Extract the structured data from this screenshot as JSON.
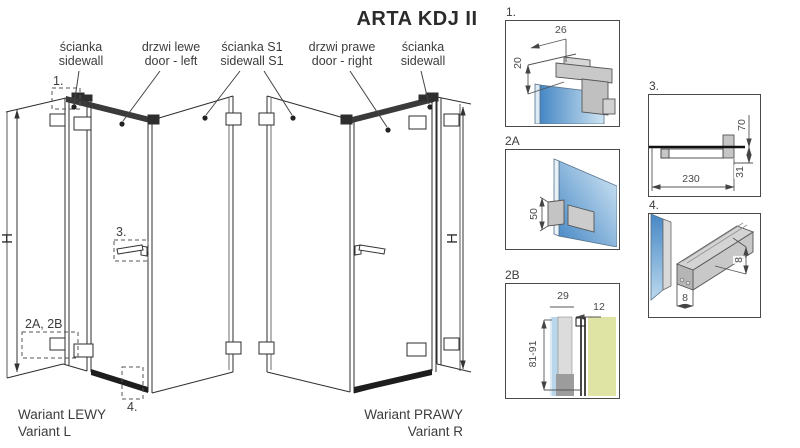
{
  "title": "ARTA KDJ II",
  "labels": {
    "sidewall_l": {
      "line1": "ścianka",
      "line2": "sidewall"
    },
    "door_l": {
      "line1": "drzwi lewe",
      "line2": "door - left"
    },
    "s1": {
      "line1": "ścianka S1",
      "line2": "sidewall S1"
    },
    "door_r": {
      "line1": "drzwi prawe",
      "line2": "door - right"
    },
    "sidewall_r": {
      "line1": "ścianka",
      "line2": "sidewall"
    }
  },
  "variant_left": {
    "line1": "Wariant LEWY",
    "line2": "Variant L"
  },
  "variant_right": {
    "line1": "Wariant PRAWY",
    "line2": "Variant R"
  },
  "height_label": "H",
  "callouts": {
    "c1": "1.",
    "c2": "2A, 2B",
    "c3": "3.",
    "c4": "4."
  },
  "details": {
    "d1": {
      "label": "1.",
      "dim_width": "26",
      "dim_height": "20"
    },
    "d2a": {
      "label": "2A",
      "dim_height": "50"
    },
    "d2b": {
      "label": "2B",
      "dim_w1": "29",
      "dim_w2": "12",
      "dim_range": "81-91"
    },
    "d3": {
      "label": "3.",
      "dim_h": "70",
      "dim_drop": "31",
      "dim_len": "230"
    },
    "d4": {
      "label": "4.",
      "dim_w": "8",
      "dim_h": "8"
    }
  },
  "colors": {
    "glass_blue": "#4587c4",
    "glass_light": "#d6e9f6",
    "wall_yellow": "#dfe4a4",
    "hardware_gray": "#c6c6c6",
    "line_dark": "#2e2e2e"
  }
}
